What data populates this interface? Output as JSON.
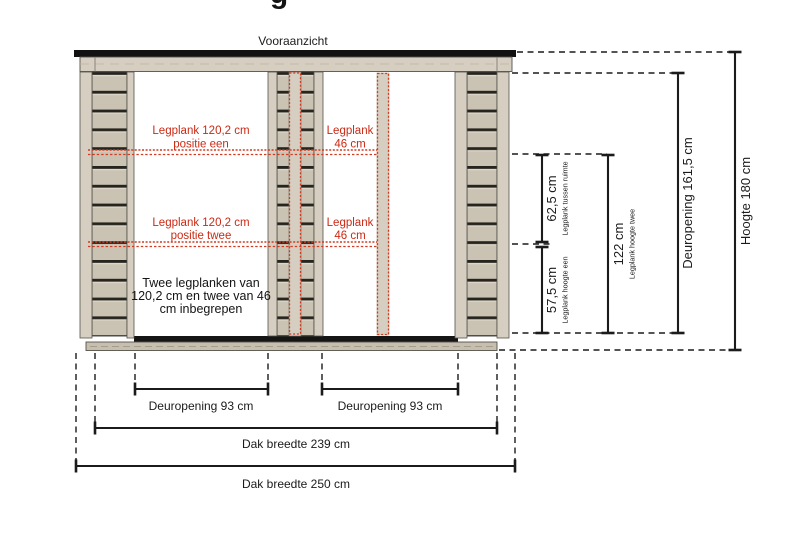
{
  "page": {
    "title_fragment": "g",
    "view_label": "Vooraanzicht"
  },
  "red_labels": {
    "shelf1_long_1": "Legplank 120,2 cm",
    "shelf1_long_2": "positie een",
    "shelf1_short_1": "Legplank",
    "shelf1_short_2": "46 cm",
    "shelf2_long_1": "Legplank 120,2 cm",
    "shelf2_long_2": "positie twee",
    "shelf2_short_1": "Legplank",
    "shelf2_short_2": "46 cm"
  },
  "note": {
    "line1": "Twee legplanken van",
    "line2": "120,2 cm en twee van 46",
    "line3": "cm inbegrepen"
  },
  "dims": {
    "shelf_gap": {
      "value": "62,5 cm",
      "sub": "Legplank tussen ruimte"
    },
    "shelf_one": {
      "value": "57,5 cm",
      "sub": "Legplank hoogte een"
    },
    "shelf_two": {
      "value": "122 cm",
      "sub": "Legplank hoogte twee"
    },
    "door_height": {
      "value": "Deuropening 161,5 cm"
    },
    "total_height": {
      "value": "Hoogte 180 cm"
    },
    "door_width_left": {
      "value": "Deuropening 93 cm"
    },
    "door_width_right": {
      "value": "Deuropening 93 cm"
    },
    "roof_width_inner": {
      "value": "Dak breedte 239 cm"
    },
    "roof_width_outer": {
      "value": "Dak breedte 250 cm"
    }
  },
  "colors": {
    "wood": "#cac3b3",
    "wood_light": "#d6cfc1",
    "gap_dark": "#26241f",
    "roof_black": "#121212",
    "red": "#cc2913",
    "red_dots": "#d43a20",
    "dim_black": "#1b1b1b",
    "base": "#c6bfaf",
    "sill": "#151515"
  }
}
